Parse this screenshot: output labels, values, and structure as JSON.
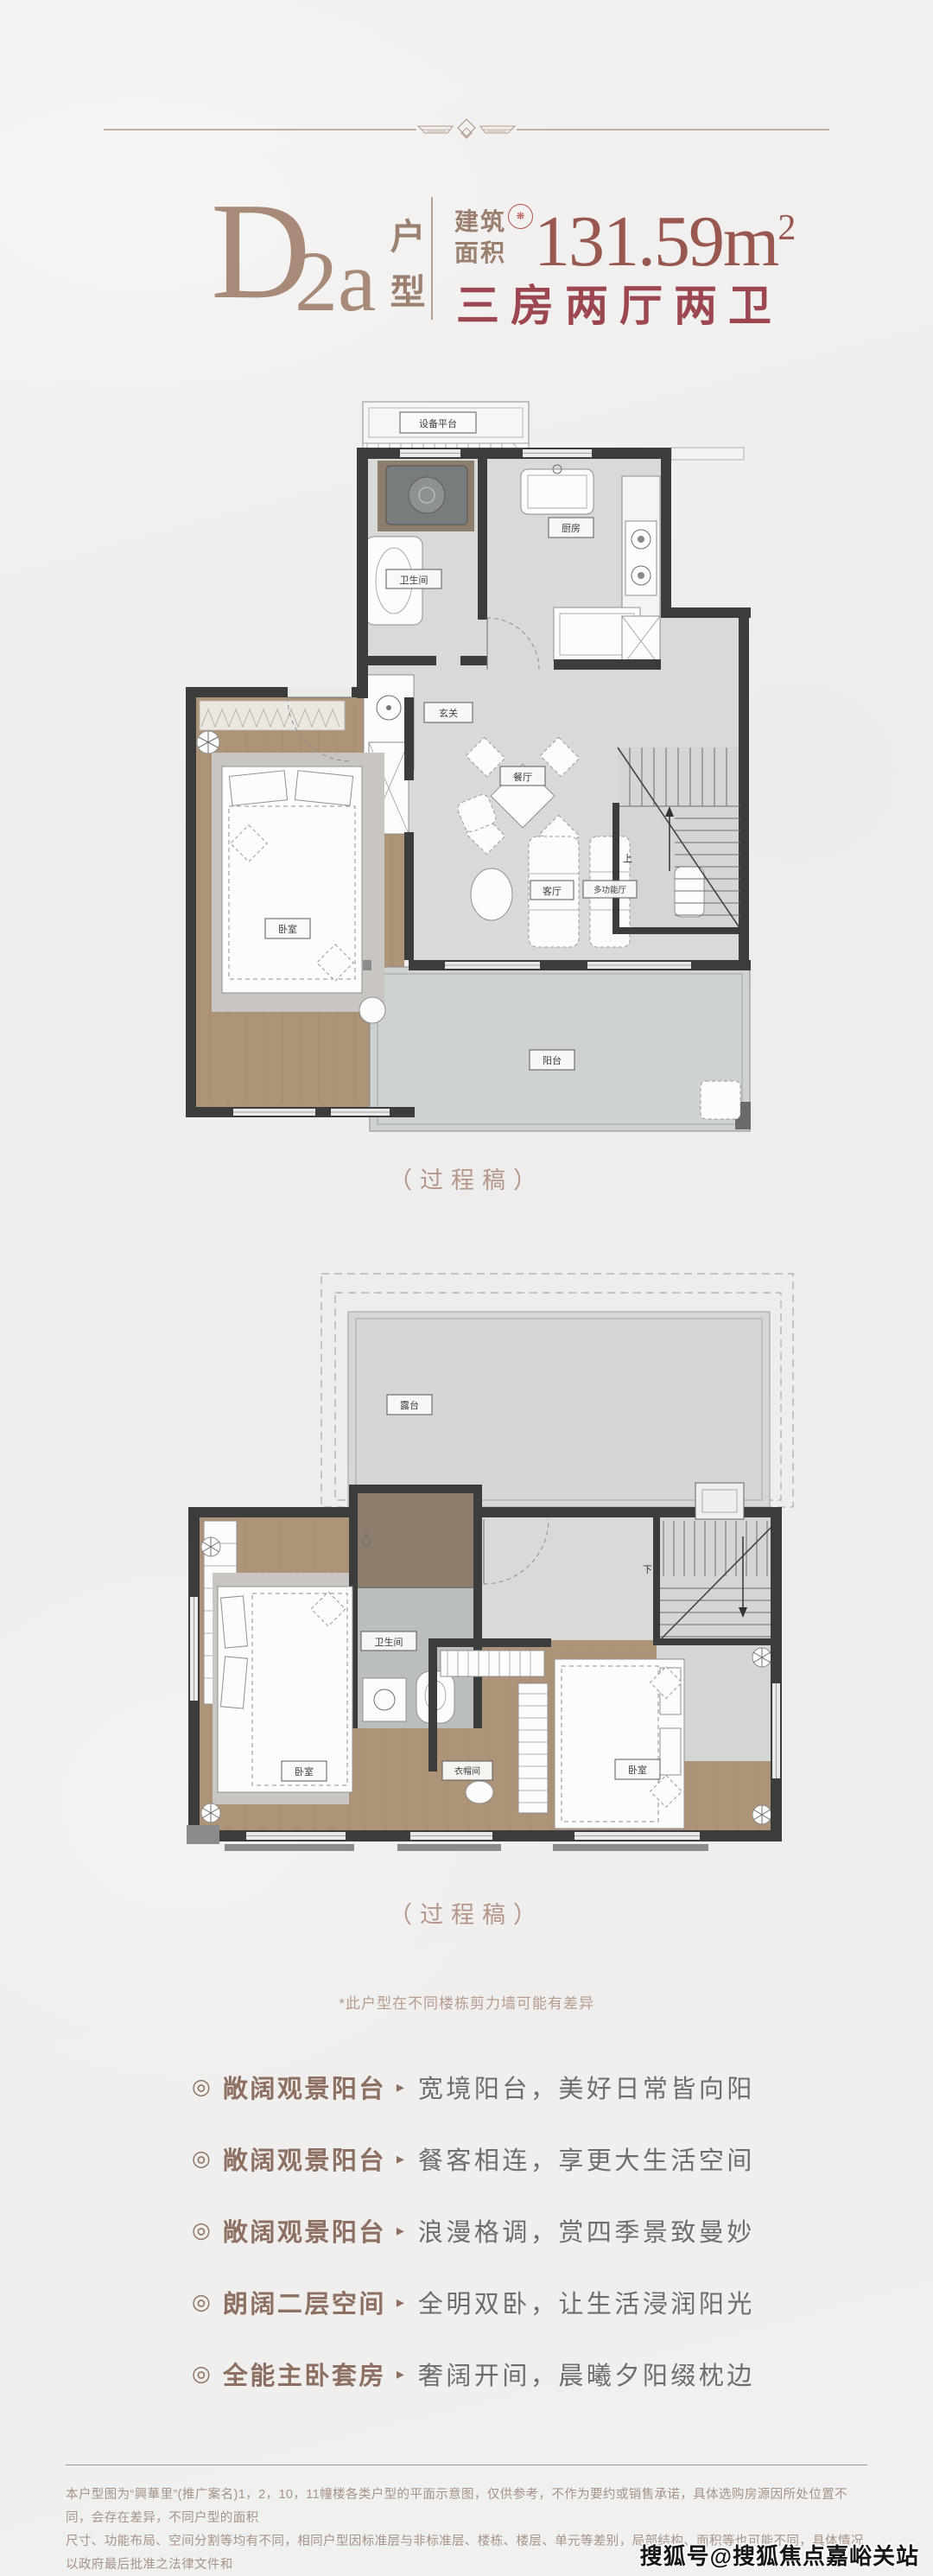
{
  "colors": {
    "accent_taupe": "#a78a77",
    "accent_brown": "#9b8070",
    "accent_red": "#9c4650",
    "area_red": "#98584f",
    "seal_red": "#b5544b",
    "caption_pink": "#b5968a",
    "feature_label": "#8d7061",
    "feature_desc": "#6e6e6e",
    "disclaimer": "#a5948a"
  },
  "ui": {
    "bullet_glyph": "◎",
    "arrow_glyph": "▸",
    "divider_icon": "diamond-ornament-divider"
  },
  "header": {
    "type_code_main": "D",
    "type_code_sub": "2a",
    "type_word_top": "户",
    "type_word_bottom": "型",
    "area_label_top": "建筑",
    "area_label_bottom": "面积",
    "seal_icon": "red-seal-stamp-icon",
    "area_value": "131.59m",
    "area_sup": "2",
    "rooms_text": "三房两厅两卫"
  },
  "plan1": {
    "caption": "（过程稿）",
    "labels": {
      "equipment": "设备平台",
      "bathroom": "卫生间",
      "kitchen": "厨房",
      "foyer": "玄关",
      "dining": "餐厅",
      "bedroom": "卧室",
      "living": "客厅",
      "multi": "多功能厅",
      "balcony": "阳台",
      "up": "上"
    }
  },
  "plan2": {
    "caption": "（过程稿）",
    "labels": {
      "terrace": "露台",
      "bathroom": "卫生间",
      "closet": "衣帽间",
      "bedroom_left": "卧室",
      "bedroom_right": "卧室",
      "down": "下"
    }
  },
  "note": {
    "text": "*此户型在不同楼栋剪力墙可能有差异"
  },
  "features": [
    {
      "label": "敞阔观景阳台",
      "desc": "宽境阳台，美好日常皆向阳"
    },
    {
      "label": "敞阔观景阳台",
      "desc": "餐客相连，享更大生活空间"
    },
    {
      "label": "敞阔观景阳台",
      "desc": "浪漫格调，赏四季景致曼妙"
    },
    {
      "label": "朗阔二层空间",
      "desc": "全明双卧，让生活浸润阳光"
    },
    {
      "label": "全能主卧套房",
      "desc": "奢阔开间，晨曦夕阳缀枕边"
    }
  ],
  "footer": {
    "line1": "本户型图为“興華里”(推广案名)1，2，10，11幢楼各类户型的平面示意图，仅供参考，不作为要约或销售承诺，具体选购房源因所处位置不同，会存在差异，不同户型的面积",
    "line2": "尺寸、功能布局、空间分割等均有不同，相同户型因标准层与非标准层、楼栋、楼层、单元等差别，局部结构、面积等也可能不同，具体情况以政府最后批准之法律文件和",
    "line3": "买卖双方签订的商品房买卖合同为准。本项目政府备案核准名为“明华里”，本资料制作时间为2024年10月。"
  },
  "watermark": {
    "text": "搜狐号@搜狐焦点嘉峪关站"
  }
}
